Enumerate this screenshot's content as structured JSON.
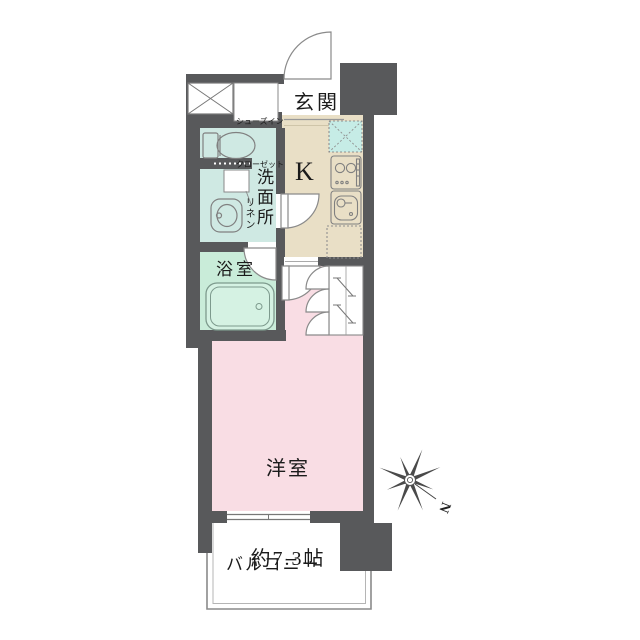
{
  "floorplan": {
    "shoes_closet": {
      "line1": "シューズイン",
      "line2": "クローゼット"
    },
    "entrance": {
      "label": "玄関"
    },
    "kitchen": {
      "label": "K"
    },
    "washroom": {
      "label": "洗面所"
    },
    "linen": {
      "label": "リネン"
    },
    "bathroom": {
      "label": "浴室"
    },
    "western_room": {
      "name": "洋室",
      "size": "約7.3帖"
    },
    "balcony": {
      "label": "バルコニー"
    },
    "compass": {
      "north": "N"
    },
    "colors": {
      "wall": "#58595b",
      "washroom_fill": "#cfe9e3",
      "bathroom_fill": "#c9ecd9",
      "kitchen_fill": "#e9dfc6",
      "room_fill": "#f9dde4",
      "washer_pan_fill": "#c6ece6",
      "bathtub_fill": "#d5f2e3",
      "line": "#888888"
    }
  }
}
